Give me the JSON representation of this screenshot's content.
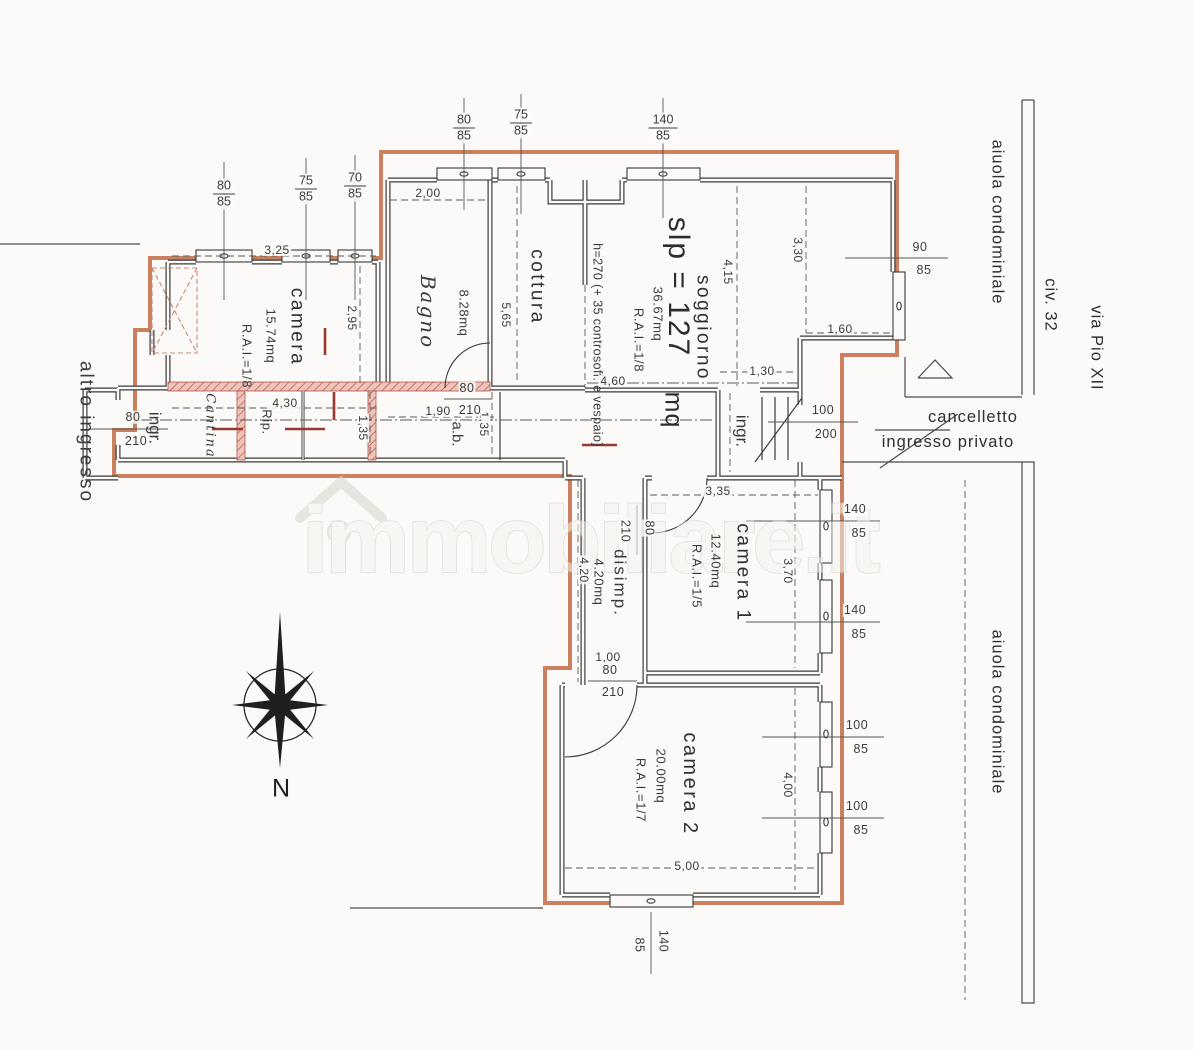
{
  "watermark": {
    "text": "immobiliare.it"
  },
  "compass": {
    "north_label": "N"
  },
  "site": {
    "street_name": "via Pio XII",
    "street_number": "civ. 32",
    "aiuola_top": "aiuola condominiale",
    "aiuola_bottom": "aiuola condominiale",
    "gate_line1": "cancelletto",
    "gate_line2": "ingresso privato",
    "other_entrance": "altro ingresso"
  },
  "plan": {
    "slp": "slp = 127",
    "slp_unit": "mq",
    "height_note": "h=270 (+ 35 controsoff. e vespaio)",
    "rooms": {
      "camera": {
        "name": "camera",
        "area": "15.74mq",
        "rai": "R.A.I.=1/8"
      },
      "bagno": {
        "name": "Bagno",
        "area": "8.28mq"
      },
      "cottura": {
        "name": "cottura"
      },
      "soggiorno": {
        "name": "soggiorno",
        "area": "36.67mq",
        "rai": "R.A.I.=1/8"
      },
      "camera1": {
        "name": "camera 1",
        "area": "12.40mq",
        "rai": "R.A.I.=1/5"
      },
      "camera2": {
        "name": "camera 2",
        "area": "20.00mq",
        "rai": "R.A.I.=1/7"
      },
      "disimp": {
        "name": "disimp.",
        "area": "4.20mq"
      },
      "ingr_left": "ingr.",
      "ingr_right": "ingr.",
      "ab": "a.b.",
      "cantina": "Cantina",
      "rip": "Rip."
    },
    "dims": {
      "camera_w": "3,25",
      "camera_h": "2,95",
      "bagno_w": "2,00",
      "cottura_h": "5,65",
      "sogg_h": "4,15",
      "sogg_e": "3,30",
      "nook": "1,60",
      "sogg_low": "1,30",
      "sogg_w": "4,60",
      "corr_a": "4,30",
      "corr_h1": "1,35",
      "ab_w": "1,90",
      "corr_h2": "1,35",
      "cam1_w": "3,35",
      "cam1_h": "3,70",
      "disimp_h": "4,20",
      "cam2_h": "4,00",
      "cam2_w": "5,00",
      "door_w": "1,00"
    },
    "openings": {
      "win_cam_a": {
        "w": "80",
        "h": "85"
      },
      "win_cam_b": {
        "w": "75",
        "h": "85"
      },
      "win_cam_c": {
        "w": "70",
        "h": "85"
      },
      "win_up_a": {
        "w": "80",
        "h": "85"
      },
      "win_up_b": {
        "w": "75",
        "h": "85"
      },
      "win_up_c": {
        "w": "140",
        "h": "85"
      },
      "win_sogg": {
        "w": "90",
        "h": "85"
      },
      "door_main": {
        "w": "100",
        "h": "200"
      },
      "door_left": {
        "w": "80",
        "h": "210"
      },
      "door_ab": {
        "w": "80",
        "h": "210"
      },
      "door_cam1": {
        "w": "80",
        "h": "210"
      },
      "door_cam2": {
        "w": "80",
        "h": "210"
      },
      "win_c1_a": {
        "w": "140",
        "h": "85"
      },
      "win_c1_b": {
        "w": "140",
        "h": "85"
      },
      "win_c2_a": {
        "w": "100",
        "h": "85"
      },
      "win_c2_b": {
        "w": "100",
        "h": "85"
      },
      "win_c2_bottom": {
        "w": "140",
        "h": "85"
      }
    }
  },
  "colors": {
    "paper": "#fbfaf8",
    "boundary": "#c87a56",
    "wall": "#3a3a3a",
    "hatch_wall": "#e4aca3",
    "hatch_stroke": "#b0564e",
    "mark_red": "#993a30",
    "dim_text": "#3b3b3b",
    "watermark": "#d4d4cf"
  }
}
